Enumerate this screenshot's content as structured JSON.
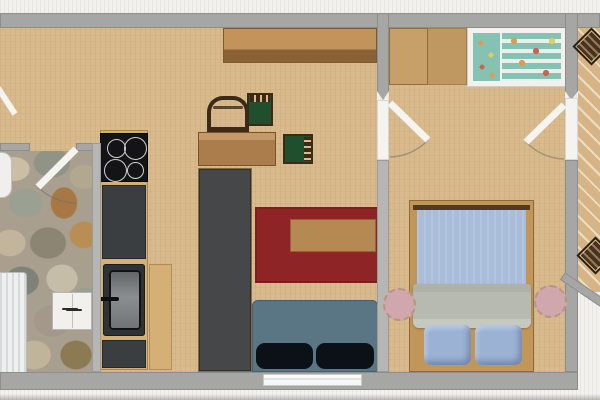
{
  "canvas": {
    "width": 600,
    "height": 400,
    "description": "2D floor plan of an apartment, top-down view, no visible text labels"
  },
  "colors": {
    "outside": "#f2f1ee",
    "stripe": "#e6e5e2",
    "wall": "#a6a6a4",
    "wall_light": "#b6b6b4",
    "wall_edge": "#8d8d8b",
    "jamb": "#f4f3f0",
    "floor": "#d9ba8c",
    "stone_base": "#a89f8e",
    "counter": "#3b3e41",
    "stove": "#141416",
    "burner_ring": "#cfd2d4",
    "sink_outer": "#303335",
    "sink_inner": "#8a8e90",
    "worktop": "#d4b077",
    "radiator": "#eef0f0",
    "white_unit": "#f1f0ed",
    "sideboard": "#c2945c",
    "sideboard_shade": "#8a6134",
    "desk": "#ab7d4c",
    "wardrobe": "#c7a069",
    "wardrobe_dark": "#b6915a",
    "crib_frame": "#f3f1ed",
    "crib_teal": "#85c2b4",
    "crib_stripe": "#e7f1e9",
    "dot_orange": "#e09a4e",
    "dot_red": "#c4674e",
    "green_seat": "#1f4f2c",
    "chair_wood": "#3b2a16",
    "dark_cabinet": "#454749",
    "rug": "#8e2425",
    "coffee": "#b48952",
    "couch": "#5a7684",
    "couch_seat": "#0c1118",
    "bed_frame": "#c09659",
    "bed_edge": "#503a20",
    "duvet": "#a9bdd9",
    "blanket": "#b7bab1",
    "pillow": "#9cb2d4",
    "stool": "#d0a7ac",
    "balcony_wood": "#d7b486",
    "balcony_gap": "#eaddc0",
    "bal_chair": "#47321f"
  },
  "rooms": [
    {
      "id": "kitchen-living",
      "floor": "light woven tan"
    },
    {
      "id": "bathroom",
      "floor": "natural stone mosaic"
    },
    {
      "id": "bedroom",
      "floor": "light woven tan"
    },
    {
      "id": "balcony",
      "floor": "diagonal wood planks"
    }
  ],
  "furniture": [
    "stove-cooktop-4-burners",
    "kitchen-counter",
    "kitchen-sink",
    "low-worktop",
    "radiator",
    "wash-basin",
    "bathroom-cabinet",
    "sideboard",
    "desk",
    "wooden-armchair",
    "green-chair-1",
    "green-chair-2",
    "tall-dark-cabinet",
    "red-rug",
    "coffee-table",
    "sofa-two-seats",
    "wardrobe",
    "crib-with-patterned-bedding",
    "double-bed",
    "stool-left",
    "stool-right",
    "balcony-chair-top",
    "balcony-chair-bottom"
  ],
  "doors": [
    "entrance-door-partial",
    "bathroom-door",
    "bedroom-door",
    "balcony-door"
  ],
  "windows": [
    "living-room-window"
  ]
}
